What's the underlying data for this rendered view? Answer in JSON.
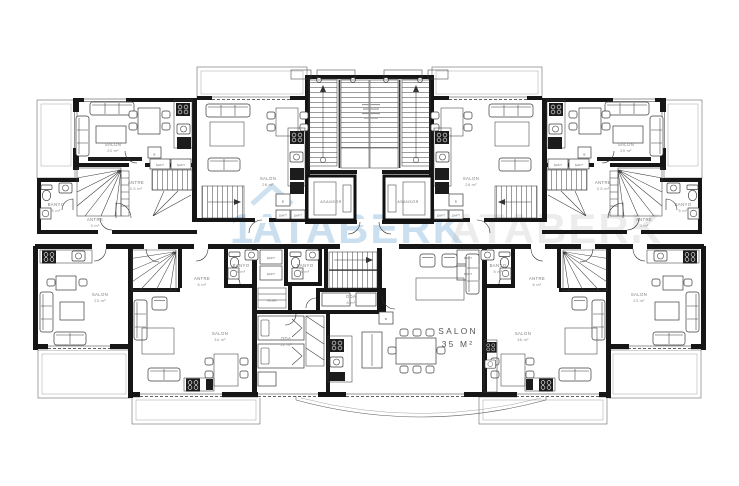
{
  "watermark": {
    "prefix": "1",
    "name": "ATABERK",
    "accent_color": "#9ec4e2"
  },
  "rooms": {
    "salon20": {
      "name": "SALON",
      "area": "20 m²"
    },
    "salon28": {
      "name": "SALON",
      "area": "28 m²"
    },
    "salon23": {
      "name": "SALON",
      "area": "23 m²"
    },
    "salon34": {
      "name": "SALON",
      "area": "34 m²"
    },
    "salon35": {
      "name": "SALON",
      "area": "35 M²"
    },
    "salon36": {
      "name": "SALON",
      "area": "36 m²"
    },
    "antre3": {
      "name": "ANTRE",
      "area": "3 m²"
    },
    "antre35": {
      "name": "ANTRE",
      "area": "3.5 m²"
    },
    "antre6": {
      "name": "ANTRE",
      "area": "6 m²"
    },
    "banyo5": {
      "name": "BANYO",
      "area": "5 m²"
    },
    "oda8": {
      "name": "ODA",
      "area": "8 m²"
    },
    "oda12": {
      "name": "ODA",
      "area": "12 m²"
    },
    "kiler": {
      "name": "KİLER"
    },
    "asansor": {
      "name": "ASANSÖR"
    },
    "saft": {
      "name": "ŞAFT"
    },
    "b": {
      "name": "B"
    }
  }
}
